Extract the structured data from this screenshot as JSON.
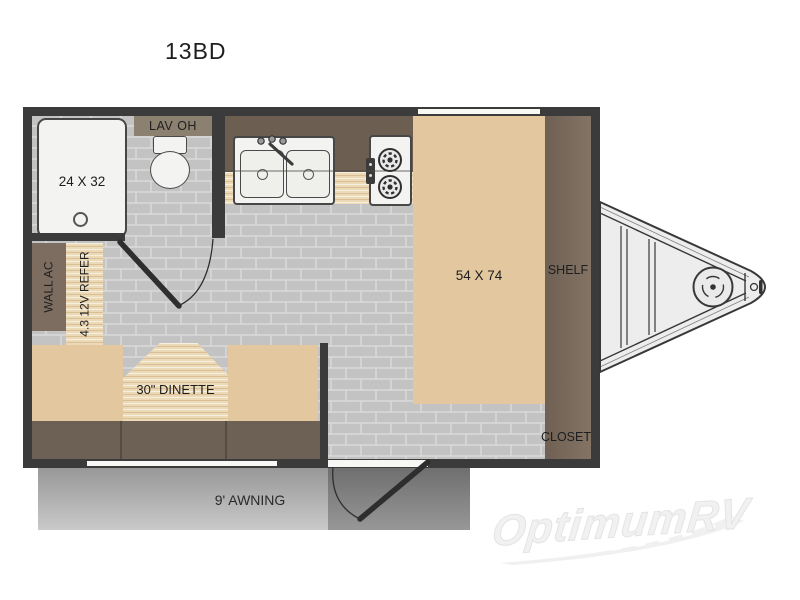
{
  "title": "13BD",
  "floorplan": {
    "bathroom": {
      "shower_size": "24 X 32",
      "overhead_cabinet": "LAV OH"
    },
    "bed": {
      "size": "54 X 74"
    },
    "shelf": "SHELF",
    "closet": "CLOSET",
    "wall_ac": "WALL AC",
    "refrigerator": "4.3 12V REFER",
    "dinette": "30\" DINETTE",
    "awning": "9' AWNING"
  },
  "watermark": "OptimumRV",
  "colors": {
    "wall": "#3b3b3b",
    "floor_brick": "#c3c3c3",
    "furniture_tan": "#e2c79f",
    "cabinet_brown": "#6d5e52",
    "shelf_brown": "#7b6b5c",
    "wood_counter": "#ecd9b6",
    "awning_gray": "#a9a9a9"
  }
}
